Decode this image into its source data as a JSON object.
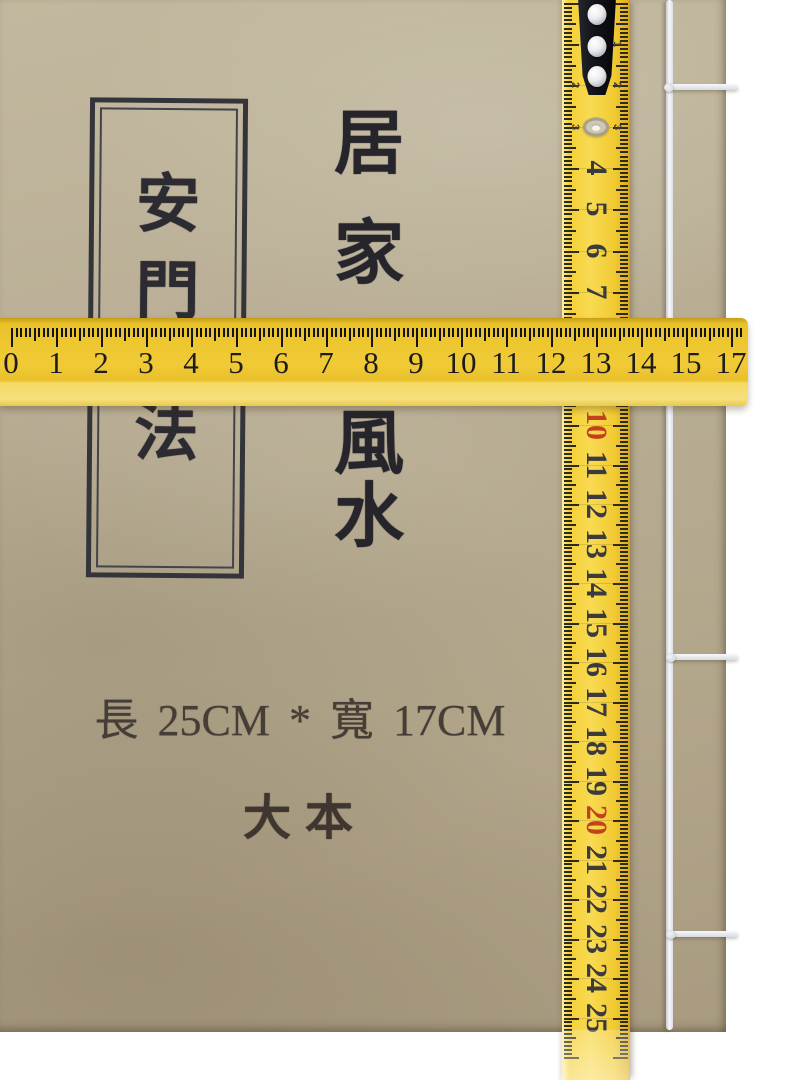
{
  "cover": {
    "frame_title": "安門法",
    "frame_title_chars": [
      "安",
      "門",
      "法"
    ],
    "main_title": "居家風水",
    "main_title_chars": [
      "居",
      "家",
      "風",
      "水"
    ],
    "size_text": "長 25CM * 寬 17CM",
    "edition_text": "大本"
  },
  "horizontal_ruler": {
    "labels": [
      "0",
      "1",
      "2",
      "3",
      "4",
      "5",
      "6",
      "7",
      "8",
      "9",
      "10",
      "11",
      "12",
      "13",
      "14",
      "15",
      "17"
    ]
  },
  "vertical_tape": {
    "numbers_above_ruler": [
      "4",
      "5",
      "6",
      "7"
    ],
    "numbers_below_ruler": [
      "10",
      "11",
      "12",
      "13",
      "14",
      "15",
      "16",
      "17",
      "18",
      "19",
      "20",
      "21",
      "22",
      "23",
      "24",
      "25"
    ],
    "red_numbers": [
      "10",
      "20"
    ],
    "edge_numbers_left": [
      "2",
      "3"
    ],
    "edge_numbers_right": [
      "1",
      "2",
      "3"
    ]
  },
  "colors": {
    "ruler_yellow": "#eec72f",
    "tape_yellow": "#f4d041",
    "kraft_paper": "#b8ad93",
    "ink_black": "#2c2b31",
    "red_number": "#c4411d",
    "thread_white": "#f1f3f6",
    "clip_black": "#17171f"
  }
}
